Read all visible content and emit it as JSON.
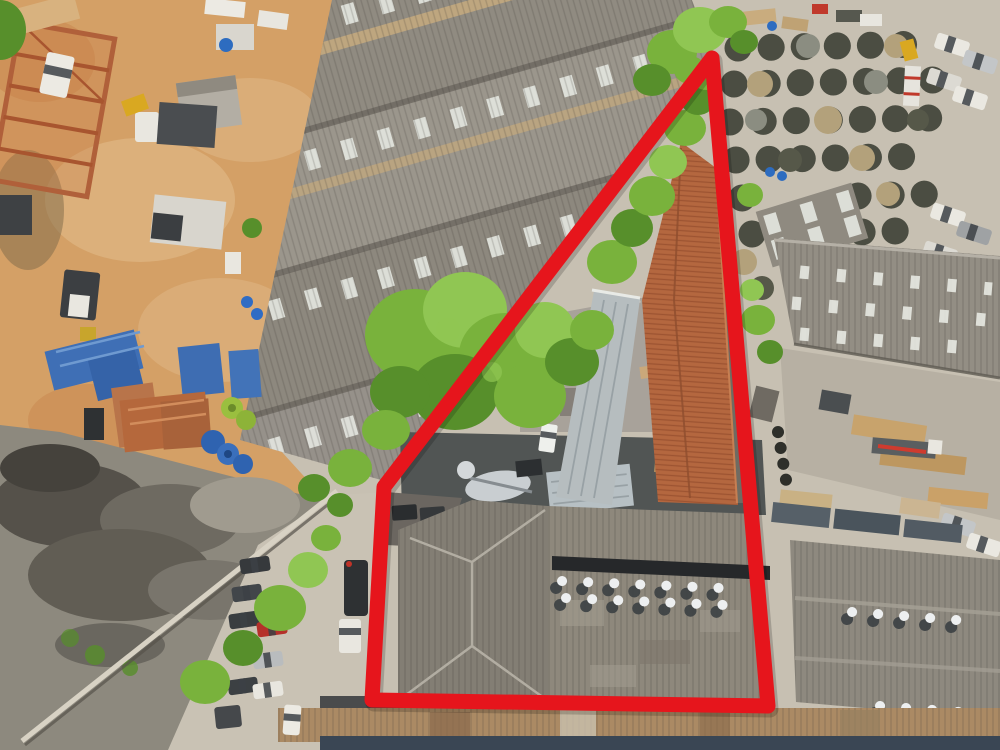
{
  "scene": {
    "title": "Aerial drone view of an industrial district with a red property boundary outline",
    "view": "top-down aerial photograph",
    "setting": "warehouses, construction dirt yard, cable reel storage, gravel piles and parked vehicles"
  },
  "boundary": {
    "points": "712,58 384,487 372,700 768,706",
    "color": "#e6151c",
    "stroke_width": 15,
    "style": "closed polygon with rounded corners"
  },
  "palette": {
    "concrete": "#c7c0b2",
    "dirt": "#d4a066",
    "dirt_light": "#e2bd8d",
    "gravel": "#8d897e",
    "street": "#c9c2b4",
    "warehouse_gray": "#9a958b",
    "roof_se": "#8e887c",
    "hip_roof": "#837e74",
    "terracotta": "#b4673f",
    "metal_roof": "#b6bdbf",
    "tree_green": "#79b23c",
    "rust_roof": "#ab8a64",
    "navy_roof": "#3a4654",
    "skylight": "#e3e5de",
    "vent_white": "#eef0ee",
    "right_roof": "#938e84"
  },
  "regions": {
    "top_left": "construction dirt yard with rusty steel frame and trucks",
    "top_center": "stepped gray warehouse roofs with skylight rows",
    "top_right": "cable reel storage yard with rows of parked white cars",
    "center": "tree line along boundary; terracotta tiled roof inside property",
    "bottom_left": "gravel piles, perimeter wall and street with parked cars",
    "bottom_center": "large gray warehouse roof with turbine vents inside property",
    "bottom_right": "adjacent warehouse roofs with turbine vents",
    "bottom_strip": "rusty corrugated roof strip and dark blue roof strip"
  }
}
